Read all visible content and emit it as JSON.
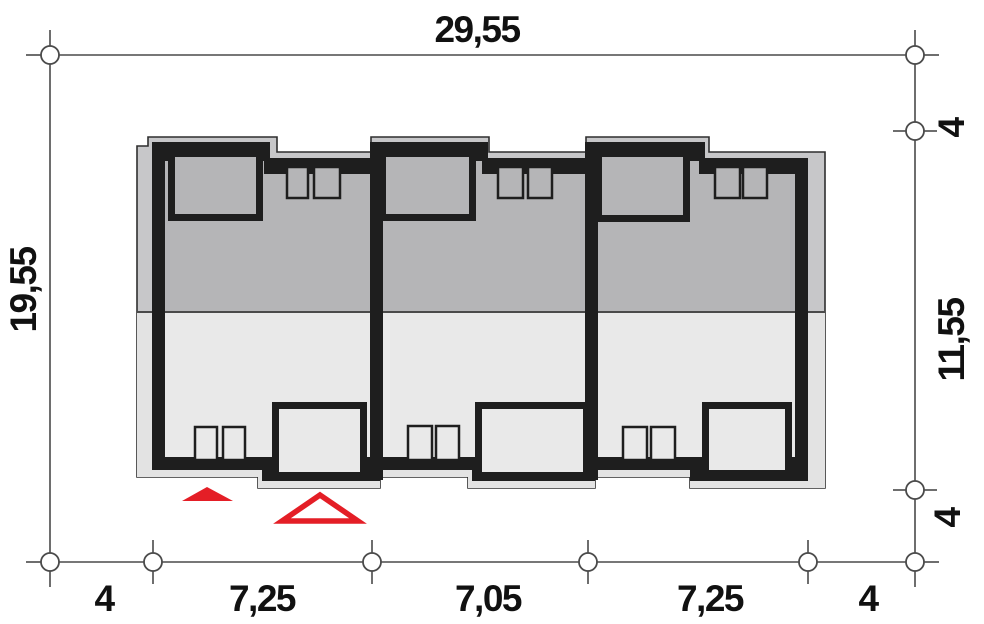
{
  "plan": {
    "type": "site-plan-floor-plan",
    "dimensions": {
      "top_total": "29,55",
      "left_total": "19,55",
      "right": [
        "4",
        "11,55",
        "4"
      ],
      "bottom": [
        "4",
        "7,25",
        "7,05",
        "7,25",
        "4"
      ]
    },
    "colors": {
      "accent_red": "#e41e26",
      "wall_black": "#1e1e1e",
      "roof_upper_gray": "#c7c7c9",
      "roof_lower_gray": "#e3e3e3",
      "interior_upper_gray": "#b5b5b7",
      "interior_lower_gray": "#e9e9e9",
      "dimension_line_gray": "#4a4a4a"
    },
    "icons": {
      "entrance_filled_triangle": "filled-red-triangle-marker",
      "entrance_outlined_triangle": "outlined-red-triangle-marker"
    }
  }
}
